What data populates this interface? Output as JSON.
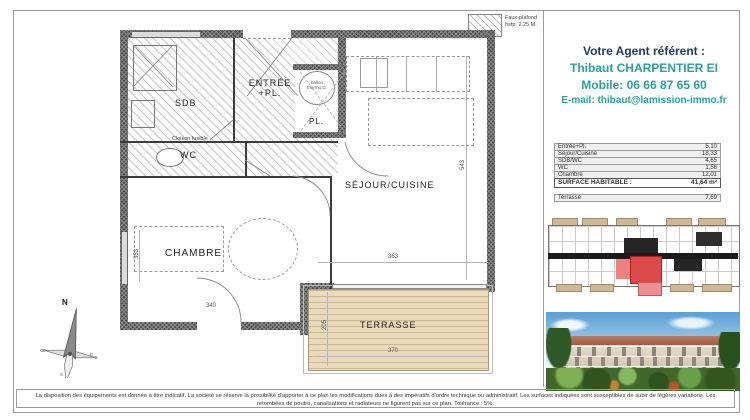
{
  "sheet": {
    "legend_line1": "Faux-plafond",
    "legend_line2": "hsfp: 2.25 M.",
    "disclaimer": "La disposition des équipements est donnée à titre indicatif. La société se réserve la possibilité d'apporter à ce plan les modifications dues à des impératifs d'ordre technique ou administratif. Les surfaces indiquées sont susceptibles de subir de légères variations. Les retombées de poutre, canalisations et radiateurs ne figurent pas sur ce plan. Tolérance : 5%."
  },
  "compass": {
    "north": "N",
    "west": "O",
    "east": "E",
    "south": "S"
  },
  "plan": {
    "rooms": {
      "sdb": "SDB",
      "entree_line1": "ENTRÉE",
      "entree_line2": "+PL.",
      "pl": "PL.",
      "wc": "WC",
      "sejour": "SÉJOUR/CUISINE",
      "chambre": "CHAMBRE",
      "terrasse": "TERRASSE"
    },
    "annotations": {
      "cloison": "Cloison fusible",
      "ballon_line1": "ballon",
      "ballon_line2": "thermo.D."
    },
    "dimensions": {
      "sejour_height": "543",
      "bay_width": "363",
      "terrace_width": "370",
      "terrace_depth": "205",
      "chambre_door": "340",
      "chambre_height": "353"
    }
  },
  "agent": {
    "title": "Votre Agent référent :",
    "name": "Thibaut CHARPENTIER EI",
    "mobile": "Mobile: 06 66 87 65 60",
    "email": "E-mail: thibaut@lamission-immo.fr"
  },
  "areas": {
    "rows": [
      {
        "label": "Entrée+Pl.",
        "value": "5,10"
      },
      {
        "label": "Séjour/Cuisine",
        "value": "18,33"
      },
      {
        "label": "SDB/WC",
        "value": "4,65"
      },
      {
        "label": "WC",
        "value": "1,56"
      },
      {
        "label": "Chambre",
        "value": "12,01"
      }
    ],
    "total_label": "SURFACE HABITABLE :",
    "total_value": "41,64 m²",
    "terrace_label": "Terrasse",
    "terrace_value": "7,69"
  },
  "colors": {
    "accent_teal": "#29a29b",
    "accent_navy": "#223a66",
    "unit_highlight_red": "#dd4a4a",
    "terrace_wood": "#ead9ba"
  }
}
